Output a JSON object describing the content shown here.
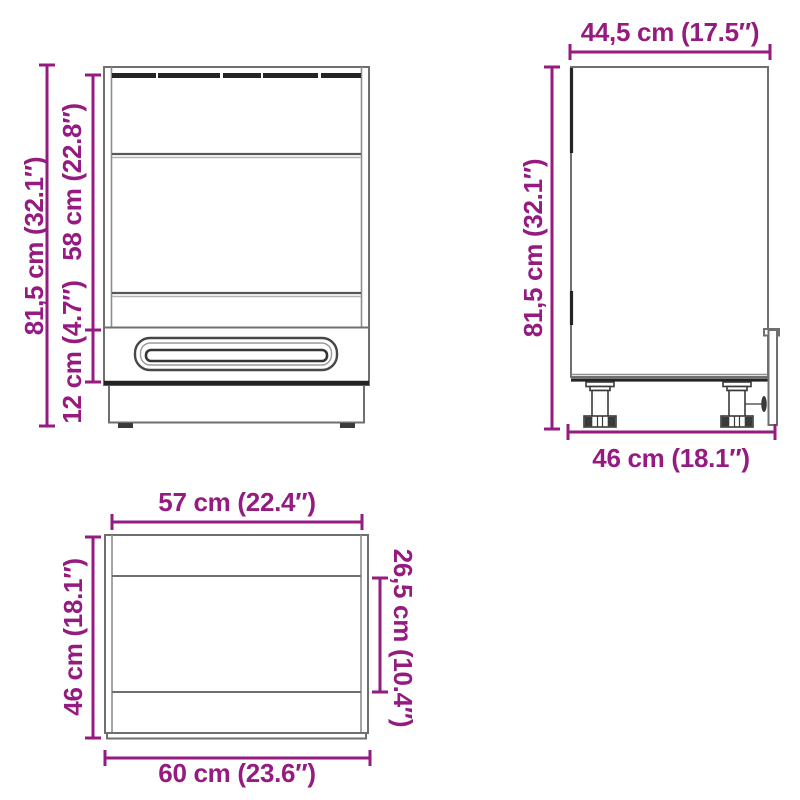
{
  "diagram": {
    "type": "furniture-dimension-diagram",
    "background": "#ffffff",
    "dimension_color": "#951b81",
    "line_color": "#6f6f6f",
    "dark_line_color": "#242424"
  },
  "front_view": {
    "total_height": "81,5 cm (32.1″)",
    "niche_height": "58 cm (22.8″)",
    "drawer_height": "12 cm (4.7″)"
  },
  "side_view": {
    "top_depth": "44,5 cm (17.5″)",
    "height": "81,5 cm (32.1″)",
    "bottom_depth": "46 cm (18.1″)"
  },
  "top_view": {
    "inner_width": "57 cm (22.4″)",
    "left_depth": "46 cm (18.1″)",
    "inner_depth": "26,5 cm (10.4″)",
    "outer_width": "60 cm (23.6″)"
  }
}
